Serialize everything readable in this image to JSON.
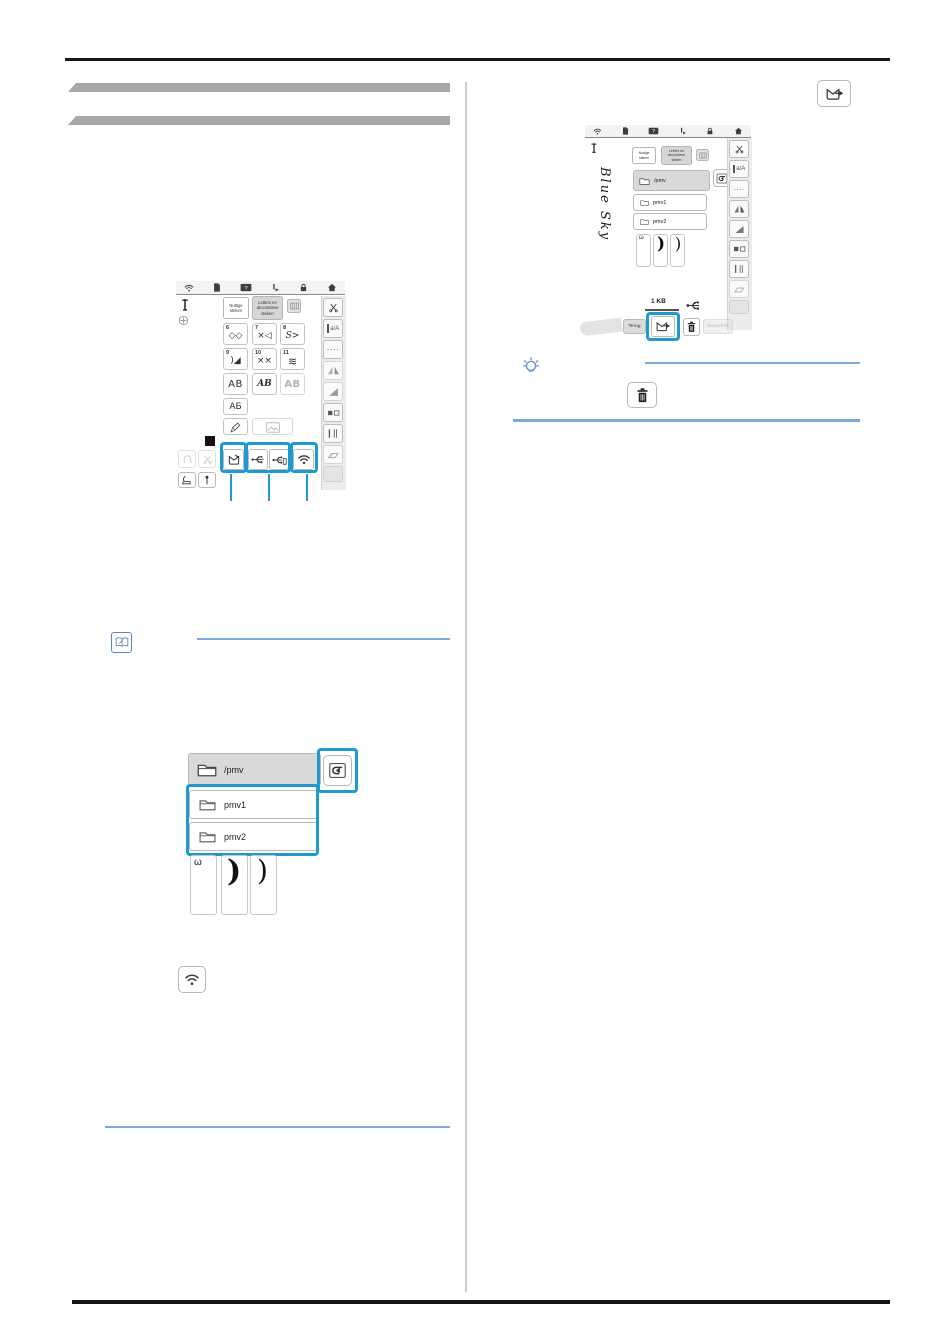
{
  "colors": {
    "callout_blue": "#1d9ad2",
    "guide_line_blue": "#7da9d8",
    "note_icon_blue": "#5b84b8"
  },
  "machine_ui": {
    "tabs": {
      "utility": "Nuttige steken",
      "letters": "Letters en decoratieve steken"
    },
    "toolbar": {
      "help_glyph": "?"
    },
    "sidebar": {
      "case_label": "a/A",
      "dots_label": "····"
    },
    "stitch_categories": [
      {
        "num": "6",
        "glyph": "◇◇"
      },
      {
        "num": "7",
        "glyph": "×◁"
      },
      {
        "num": "8",
        "glyph": "S>"
      },
      {
        "num": "9",
        "glyph": ")◢"
      },
      {
        "num": "10",
        "glyph": "××"
      },
      {
        "num": "11",
        "glyph": "≋"
      }
    ],
    "letter_buttons": {
      "sans": "AB",
      "script": "AB",
      "outline": "AB",
      "cyrillic": "АБ"
    }
  },
  "folder_browser": {
    "path": "/pmv",
    "folder1": "pmv1",
    "folder2": "pmv2",
    "thumbs": {
      "t1": "ω",
      "t2": ")",
      "t3": ")"
    }
  },
  "edit_screen": {
    "handwriting": "Blue Sky",
    "file_size": "1 KB",
    "back_label": "Terug",
    "edit_label": "Bewerken"
  }
}
